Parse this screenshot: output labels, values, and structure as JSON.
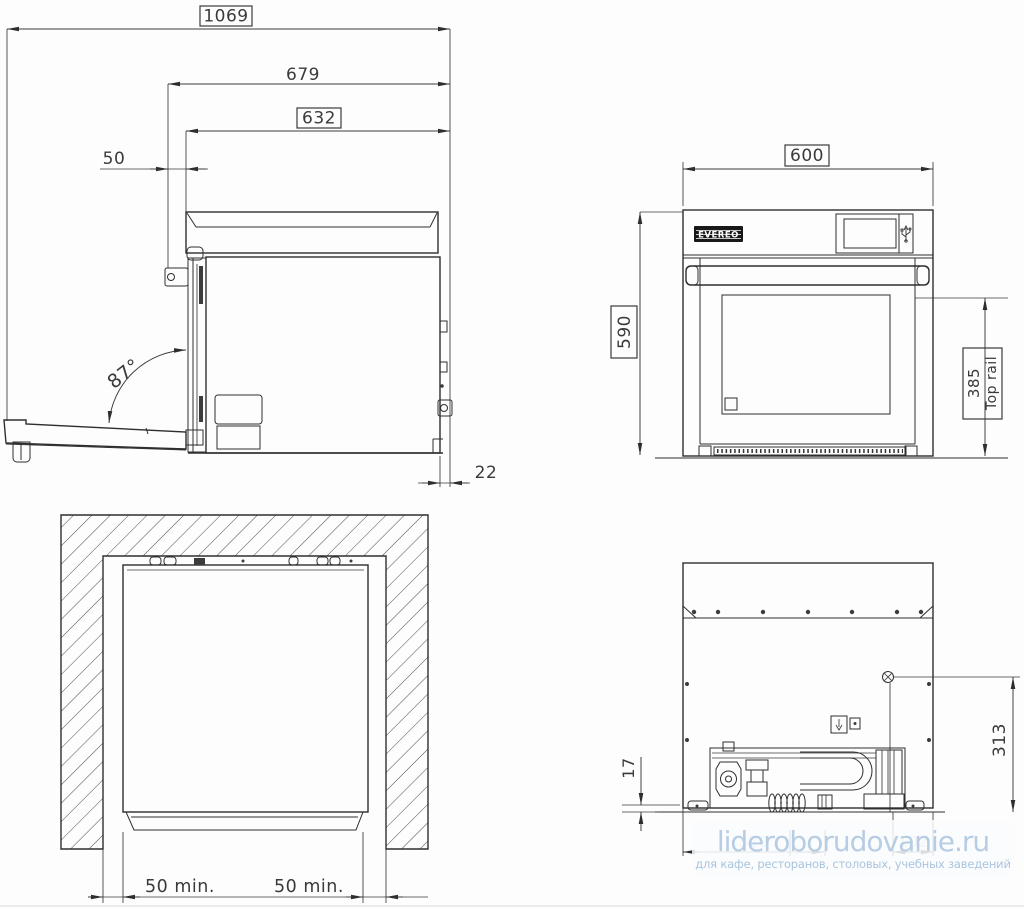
{
  "side_view": {
    "dim_total_depth": "1069",
    "dim_door_open_depth": "679",
    "dim_body_depth": "632",
    "dim_front_offset": "50",
    "door_open_angle": "87°",
    "dim_rear_gap": "22"
  },
  "front_view": {
    "brand": "EVEREO",
    "dim_width": "600",
    "dim_height": "590",
    "dim_top_rail": "385",
    "top_rail_label": "Top rail"
  },
  "install_view": {
    "dim_left_clearance": "50 min.",
    "dim_right_clearance": "50 min."
  },
  "rear_view": {
    "dim_bottom_gap": "17",
    "dim_connector_height": "313",
    "dim_obscured_left": "320",
    "dim_obscured_right": "102"
  },
  "watermark": {
    "site": "lideroborudovanie.ru",
    "tagline": "для кафе, ресторанов, столовых, учебных заведений"
  },
  "colors": {
    "line": "#2e2e2e",
    "watermark_text": "#b7cde4"
  }
}
